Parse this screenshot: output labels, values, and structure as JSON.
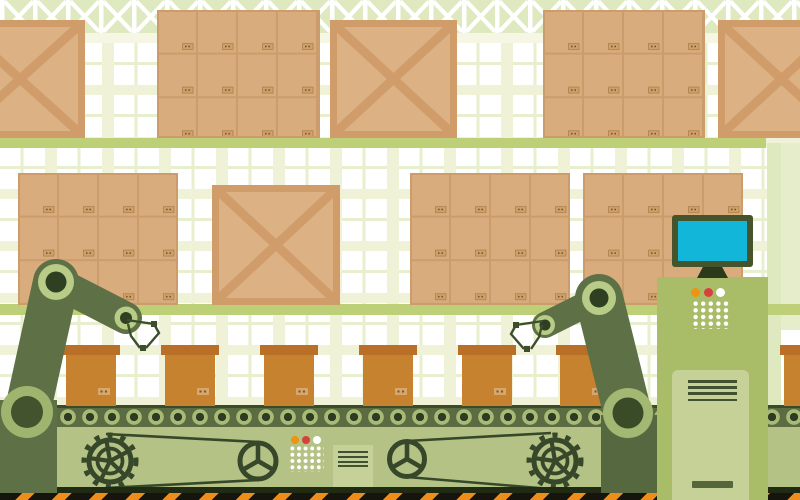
{
  "scene": {
    "title": "warehouse-automation-illustration",
    "description": "Flat vector illustration of an automated warehouse: shelves stacked with cardboard boxes and wooden crates, a conveyor belt carrying boxes, two robotic arms and a control console with a monitor.",
    "text_content": "none (illustration contains no readable text)"
  },
  "palette": {
    "wall_cream": "#f0f2d8",
    "window_white": "#ffffff",
    "window_mullion": "#e8efce",
    "truss_band": "#dee9c0",
    "truss_lattice": "#ffffff",
    "under_truss_strip": "#f5f6e4",
    "shelf_green": "#bdd078",
    "column_green": "#dfe9c0",
    "column_green_light": "#e6edca",
    "carton_face": "#d9ac7e",
    "carton_line": "#cc9c6c",
    "carton_label": "#d0a067",
    "crate_face": "#dcb184",
    "crate_trim": "#d09c6a",
    "belt_strip": "#5b6c42",
    "belt_strip_edge": "#3b4a28",
    "roller_ring": "#a7bb77",
    "roller_core": "#2c3b22",
    "machine_body": "#b5c286",
    "machine_dark": "#37482a",
    "vent_panel": "#c6d099",
    "vent_line": "#3f512e",
    "hazard_black": "#15150d",
    "hazard_orange": "#ef8d1b",
    "base_edge": "#212b13",
    "arm_green": "#5e7045",
    "joint_ring": "#b8cc87",
    "joint_core": "#2f4022",
    "base_ring": "#9fb46f",
    "base_core": "#42532d",
    "gripper": "#3c4e2b",
    "console_body": "#a9bc67",
    "console_door": "#c5d197",
    "console_handle": "#55663d",
    "monitor_frame": "#45542b",
    "monitor_screen": "#12b6d9",
    "monitor_stand": "#2c3a1c",
    "light_orange": "#ee9312",
    "light_red": "#d8403c",
    "light_white": "#ffffff",
    "belt_box_lid": "#b96f28",
    "belt_box_body": "#c6822f",
    "belt_box_label": "#d7a66b"
  },
  "background": {
    "shelves": [
      {
        "name": "upper-shelf",
        "x": 0,
        "y": 138,
        "w": 766,
        "h": 10
      },
      {
        "name": "lower-shelf",
        "x": 0,
        "y": 304,
        "w": 800,
        "h": 11
      }
    ],
    "items": [
      {
        "type": "crate",
        "x": -45,
        "y": 20,
        "w": 130,
        "h": 118
      },
      {
        "type": "pile",
        "x": 157,
        "y": 10,
        "w": 163,
        "h": 128
      },
      {
        "type": "crate",
        "x": 330,
        "y": 20,
        "w": 127,
        "h": 118
      },
      {
        "type": "pile",
        "x": 543,
        "y": 10,
        "w": 162,
        "h": 128
      },
      {
        "type": "crate",
        "x": 718,
        "y": 20,
        "w": 127,
        "h": 118
      },
      {
        "type": "pile",
        "x": 18,
        "y": 173,
        "w": 160,
        "h": 132
      },
      {
        "type": "crate",
        "x": 212,
        "y": 185,
        "w": 128,
        "h": 120
      },
      {
        "type": "pile",
        "x": 410,
        "y": 173,
        "w": 160,
        "h": 132
      },
      {
        "type": "pile",
        "x": 583,
        "y": 173,
        "w": 160,
        "h": 132
      }
    ]
  },
  "conveyor": {
    "belt_boxes_x": [
      62,
      161,
      260,
      359,
      458,
      556,
      780
    ],
    "roller_pitch_px": 22,
    "indicator_lights": [
      "#ee9312",
      "#d8403c",
      "#ffffff"
    ],
    "dot_grid": {
      "cols": 5,
      "rows": 4
    },
    "gear_pairs": [
      {
        "gear": [
          110,
          461
        ],
        "wheel": [
          258,
          461
        ],
        "wheel_r": 18,
        "belts": [
          [
            106,
            434,
            259,
            442
          ],
          [
            106,
            488,
            259,
            480
          ]
        ]
      },
      {
        "gear": [
          555,
          461
        ],
        "wheel": [
          407,
          459
        ],
        "wheel_r": 17.5,
        "belts": [
          [
            551,
            433,
            407,
            441
          ],
          [
            551,
            489,
            407,
            477
          ]
        ]
      }
    ]
  },
  "console": {
    "indicator_lights": [
      "#ee9312",
      "#d8403c",
      "#ffffff"
    ],
    "dot_grid": {
      "cols": 5,
      "rows": 4
    },
    "vent_lines": 4,
    "monitor_screen_color": "#12b6d9"
  },
  "robot_arms": [
    {
      "side": "left",
      "base": [
        27,
        412
      ],
      "elbow": [
        56,
        282
      ],
      "wrist": [
        126,
        318
      ]
    },
    {
      "side": "right",
      "base": [
        628,
        413
      ],
      "elbow": [
        599,
        298
      ],
      "wrist": [
        545,
        325
      ]
    }
  ]
}
